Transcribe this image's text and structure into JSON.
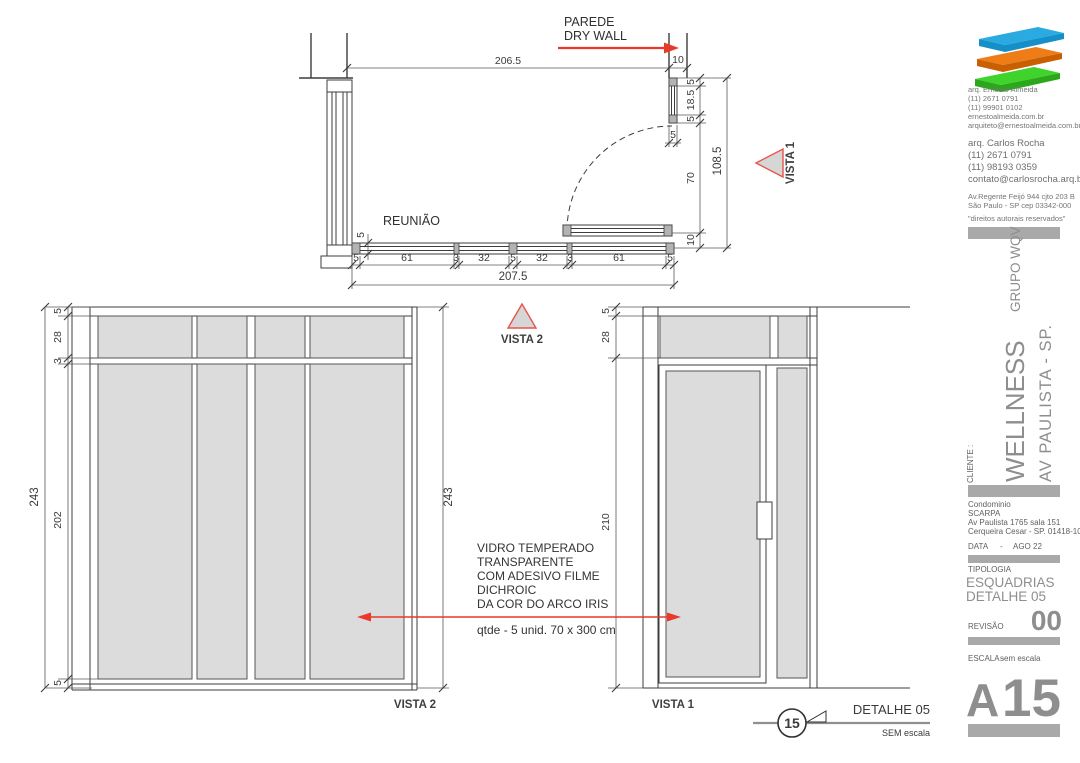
{
  "plan": {
    "wall_label_line1": "PAREDE",
    "wall_label_line2": "DRY WALL",
    "room_label": "REUNIÃO",
    "dim_top": "206.5",
    "dim_wall": "10",
    "dim_seg_top": "5",
    "dim_seg_glass": "18.5",
    "dim_seg_bot": "5",
    "dim_thk": "5",
    "dim_door": "70",
    "dim_side_total": "108.5",
    "dim_offset": "10",
    "dim_part_thk": "5",
    "chain": [
      "5",
      "61",
      "3",
      "32",
      "5",
      "32",
      "3",
      "61",
      "5"
    ],
    "dim_total": "207.5",
    "vista1_label": "VISTA 1",
    "vista2_label": "VISTA 2"
  },
  "elev_left": {
    "chain": [
      "5",
      "28",
      "3",
      "202",
      "5"
    ],
    "total_left": "243",
    "total_right": "243",
    "label": "VISTA 2"
  },
  "elev_right": {
    "chain": [
      "5",
      "28",
      "210"
    ],
    "label": "VISTA 1"
  },
  "note": {
    "lines": [
      "VIDRO TEMPERADO",
      "TRANSPARENTE",
      "COM ADESIVO FILME",
      "DICHROIC",
      "DA COR DO ARCO IRIS"
    ],
    "qty": "qtde - 5 unid. 70 x 300 cm"
  },
  "detail": {
    "number": "15",
    "title": "DETALHE 05",
    "scale": "SEM escala"
  },
  "titleblock": {
    "arch1": {
      "name": "arq. Ernesto Almeida",
      "phone1": "(11)   2671 0791",
      "phone2": "(11) 99901 0102",
      "site": "ernestoalmeida.com.br",
      "email": "arquiteto@ernestoalmeida.com.br"
    },
    "arch2": {
      "name": "arq. Carlos Rocha",
      "phone1": "(11)   2671 0791",
      "phone2": "(11) 98193 0359",
      "email": "contato@carlosrocha.arq.br"
    },
    "address1": "Av.Regente Feijó 944 cjto 203 B",
    "address2": "São Paulo - SP   cep 03342-000",
    "rights": "\"direitos autorais reservados\"",
    "cliente_label": "CLIENTE :",
    "project": "WELLNESS",
    "group": "GRUPO WQV",
    "location": "AV PAULISTA - SP.",
    "client_lines": [
      "Condominio",
      "SCARPA",
      "Av Paulista 1765 sala 151",
      "Cerqueira Cesar - SP. 01418-100"
    ],
    "date_label": "DATA",
    "date_sep": "-",
    "date_value": "AGO 22",
    "tipologia_label": "TIPOLOGIA",
    "type_line1": "ESQUADRIAS",
    "type_line2": "DETALHE 05",
    "rev_label": "REVISÃO",
    "rev_value": "00",
    "scale_label": "ESCALA -",
    "scale_value": "sem escala",
    "sheet_prefix": "A",
    "sheet_number": "15"
  },
  "colors": {
    "accent_red": "#e9392b",
    "glass": "#dcdcdc",
    "gray_bar": "#a9a9a9",
    "logo_blue": "#29abe2",
    "logo_orange": "#ef7d17",
    "logo_green": "#3fd32c"
  }
}
